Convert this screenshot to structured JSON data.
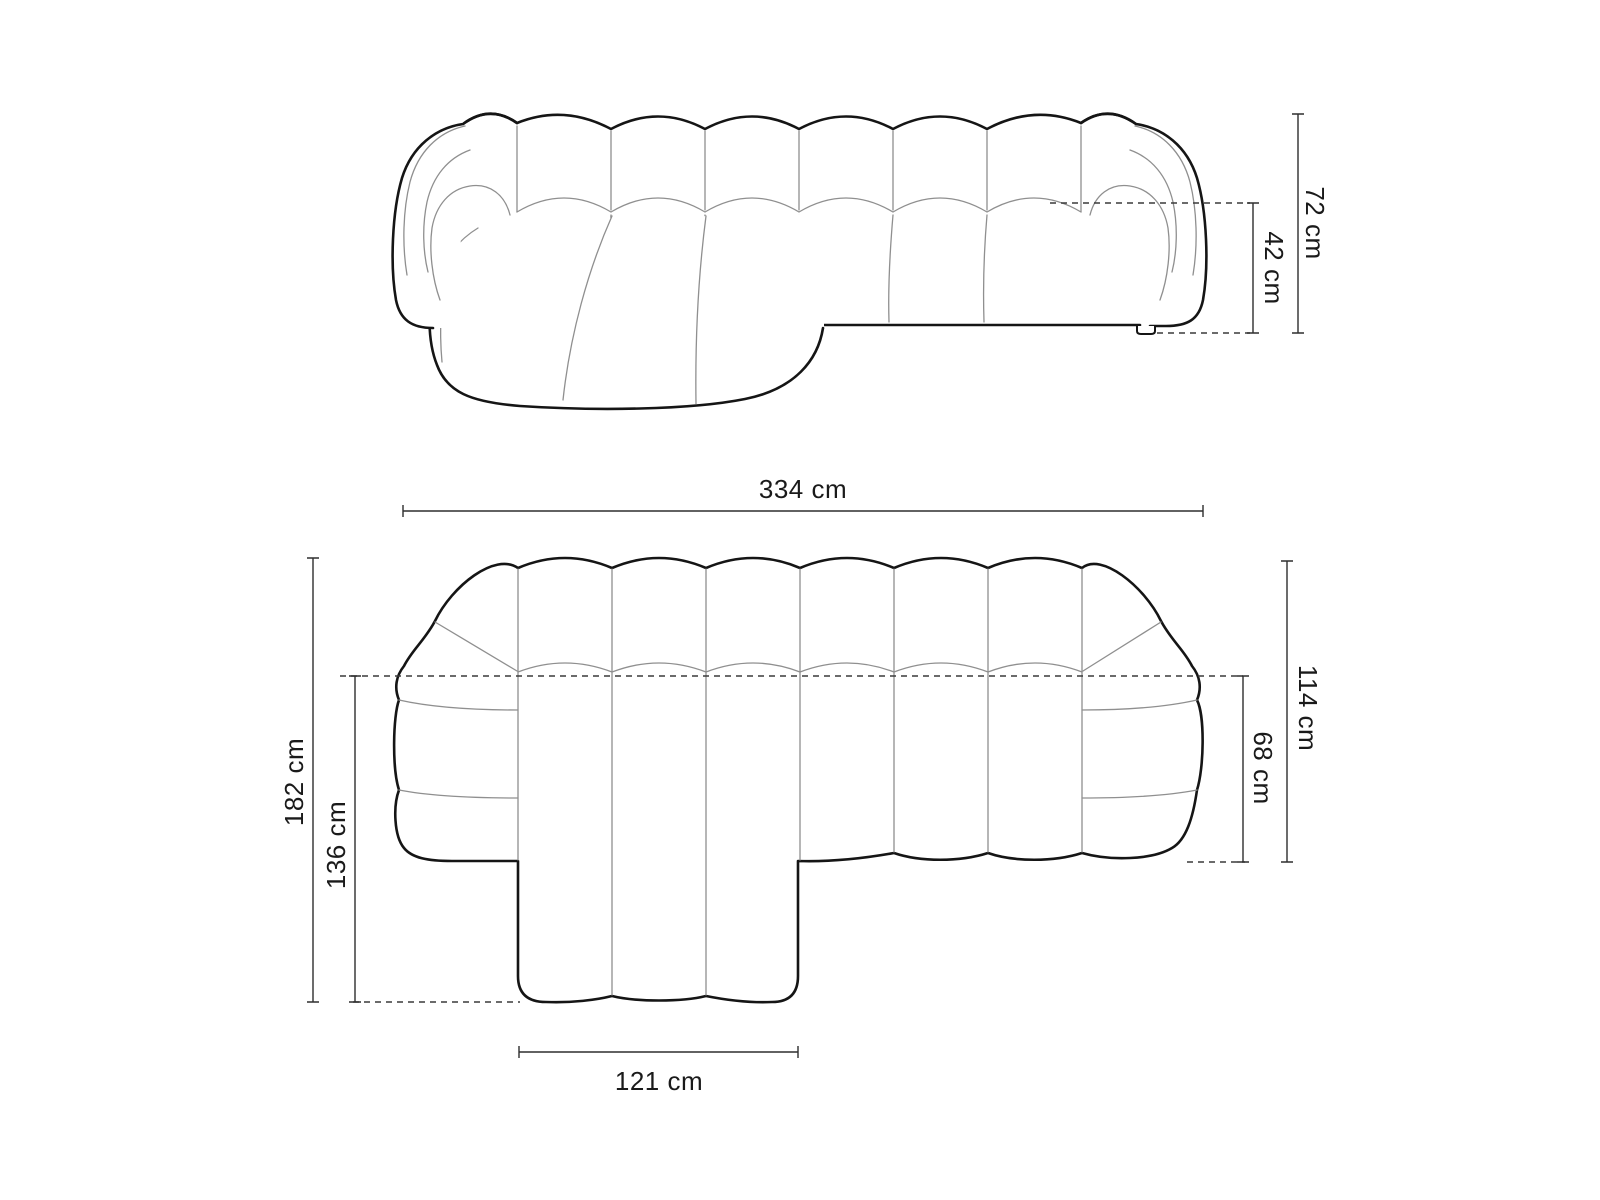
{
  "canvas": {
    "width": 1600,
    "height": 1200,
    "background": "#ffffff"
  },
  "drawing": {
    "type": "furniture-dimension-diagram",
    "subject": "modular chaise sofa line drawing, front elevation and top plan",
    "views": [
      {
        "id": "front",
        "name": "sofa front elevation"
      },
      {
        "id": "top",
        "name": "sofa top plan"
      }
    ],
    "dims": {
      "front_total_height": "72 cm",
      "front_seat_height": "42 cm",
      "top_total_width": "334 cm",
      "top_total_depth": "182 cm",
      "top_chaise_total_depth": "136 cm",
      "top_side_depth": "114 cm",
      "top_seat_depth": "68 cm",
      "top_chaise_width": "121 cm"
    },
    "colors": {
      "outline": "#151515",
      "panel_line": "#8f8f8f",
      "dimension_line": "#2e2e2e",
      "label": "#1a1a1a",
      "background": "#ffffff"
    }
  }
}
